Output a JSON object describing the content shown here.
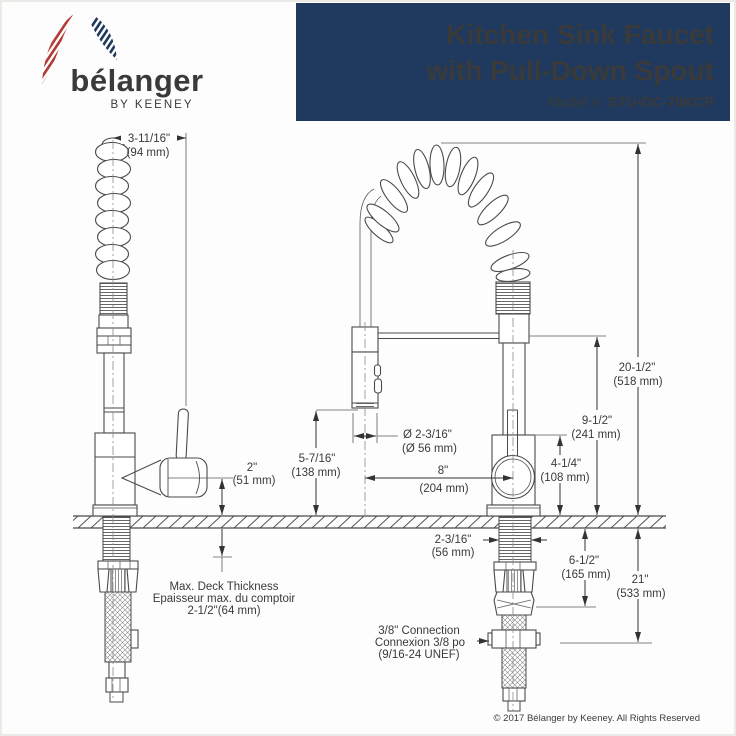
{
  "header": {
    "logo": {
      "brand": "bélanger",
      "tagline": "BY KEENEY"
    },
    "title_line1": "Kitchen Sink Faucet",
    "title_line2": "with Pull-Down Spout",
    "model_label": "Model #: ",
    "model_value": "STU-DC-78KCP"
  },
  "diagram": {
    "dims": {
      "spout_reach": {
        "in": "3-11/16\"",
        "mm": "(94 mm)"
      },
      "spout_height": {
        "in": "2\"",
        "mm": "(51 mm)"
      },
      "sprayer_height": {
        "in": "5-7/16\"",
        "mm": "(138 mm)"
      },
      "sprayer_diameter": {
        "in": "Ø 2-3/16\"",
        "mm": "(Ø 56 mm)"
      },
      "sprayer_offset": {
        "in": "8\"",
        "mm": "(204 mm)"
      },
      "body_height": {
        "in": "4-1/4\"",
        "mm": "(108 mm)"
      },
      "column_height": {
        "in": "9-1/2\"",
        "mm": "(241 mm)"
      },
      "overall_height": {
        "in": "20-1/2\"",
        "mm": "(518 mm)"
      },
      "shank_width": {
        "in": "2-3/16\"",
        "mm": "(56 mm)"
      },
      "shank_length": {
        "in": "6-1/2\"",
        "mm": "(165 mm)"
      },
      "hose_length": {
        "in": "21\"",
        "mm": "(533 mm)"
      }
    },
    "notes": {
      "deck": {
        "line1": "Max. Deck Thickness",
        "line2": "Epaisseur max. du comptoir",
        "line3": "2-1/2\"(64 mm)"
      },
      "connection": {
        "line1": "3/8\" Connection",
        "line2": "Connexion 3/8 po",
        "line3": "(9/16-24 UNEF)"
      }
    }
  },
  "footer": {
    "copyright": "© 2017 Bélanger by Keeney. All Rights Reserved"
  },
  "colors": {
    "navy": "#1f3a5e",
    "red": "#b23b35",
    "line": "#4a4a4a",
    "gray": "#8d939c"
  }
}
